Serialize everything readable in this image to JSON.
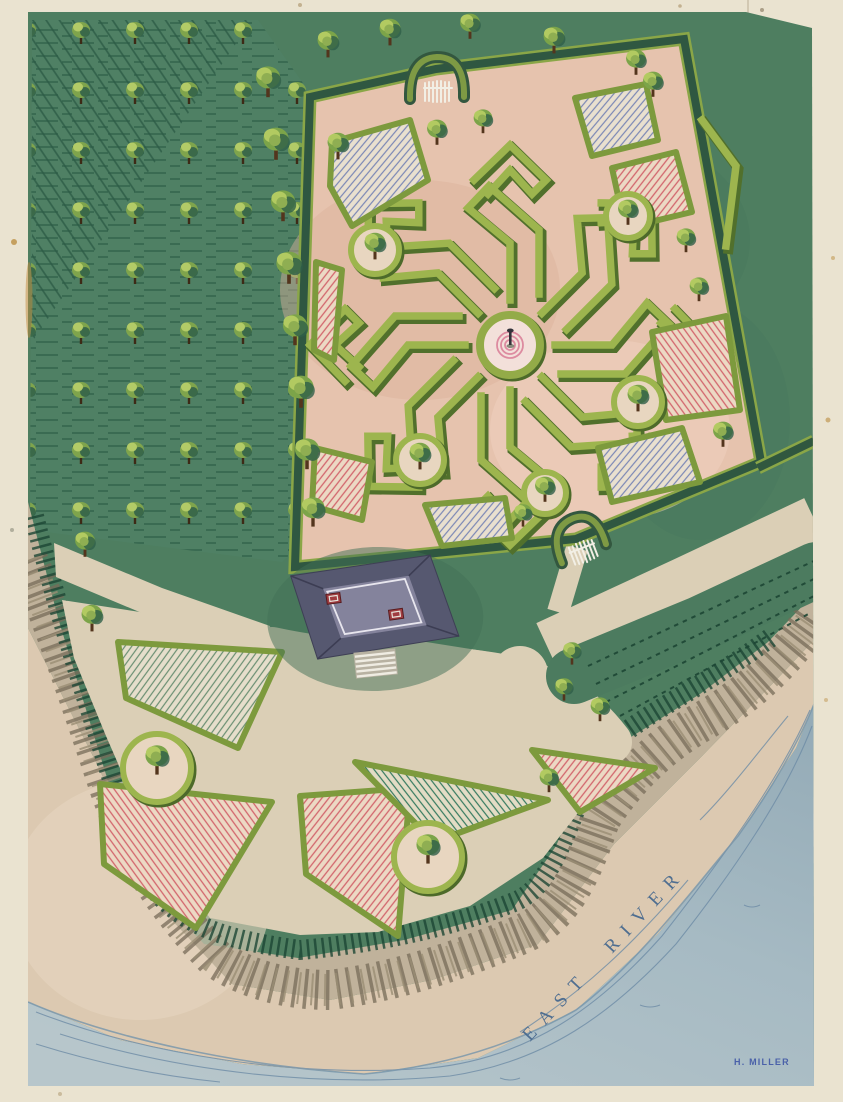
{
  "artwork": {
    "river_label": "EAST RIVER",
    "signature": "H. MILLER",
    "palette": {
      "paper": "#eae3d0",
      "lawn": "#4e7e60",
      "hedge_dark": "#2f5741",
      "hedge_light": "#9db54e",
      "maze_ground": "#e6c3ae",
      "path_tan": "#dbcfb6",
      "beach": "#dcc9b1",
      "cliff": "#c0b29b",
      "water": "#a6bac3",
      "wave_blue": "#6e8ca6",
      "roof_outer": "#565870",
      "roof_inner": "#84839c",
      "chimney_red": "#a03c40",
      "tree_green": "#7fa44c",
      "hatch_pink": "#d2656c",
      "hatch_blue": "#7a87b5",
      "hatch_teal": "#347a5f",
      "label_blue": "#44678e",
      "signature_blue": "#3d55a6"
    }
  }
}
